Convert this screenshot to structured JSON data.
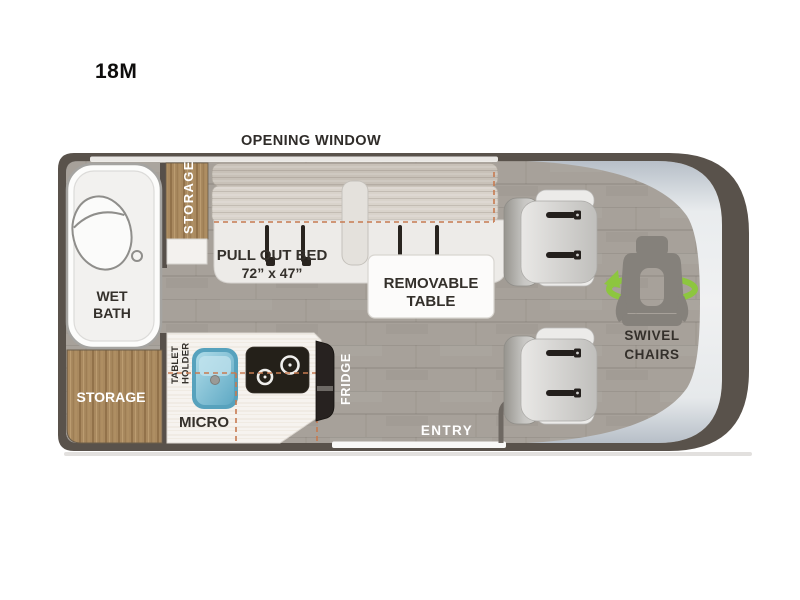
{
  "page": {
    "model_label": "18M"
  },
  "floorplan": {
    "window_label": "OPENING WINDOW",
    "entry_label": "ENTRY",
    "bath": {
      "line1": "WET",
      "line2": "BATH"
    },
    "storage_upper_label": "STORAGE",
    "storage_lower_label": "STORAGE",
    "bed": {
      "label": "PULL OUT BED",
      "size": "72” x 47”"
    },
    "table": {
      "line1": "REMOVABLE",
      "line2": "TABLE"
    },
    "kitchen": {
      "tablet_holder_line1": "TABLET",
      "tablet_holder_line2": "HOLDER",
      "micro_label": "MICRO",
      "fridge_label": "FRIDGE"
    },
    "swivel": {
      "line1": "SWIVEL",
      "line2": "CHAIRS"
    }
  },
  "colors": {
    "wall": "#59524b",
    "floor": "#a7a19a",
    "wood": "#a9895f",
    "cab_silver": "#ccd2d7",
    "cushion": "#cfc8c0",
    "bed_platform": "#edebe8",
    "counter": "#f6f3ef",
    "sink_blue": "#6fb9d0",
    "appliance_black": "#242019",
    "dashed_outline": "#c77a50",
    "accent_green": "#8dc63f",
    "label_dark": "#34302b",
    "label_white": "#ffffff"
  }
}
